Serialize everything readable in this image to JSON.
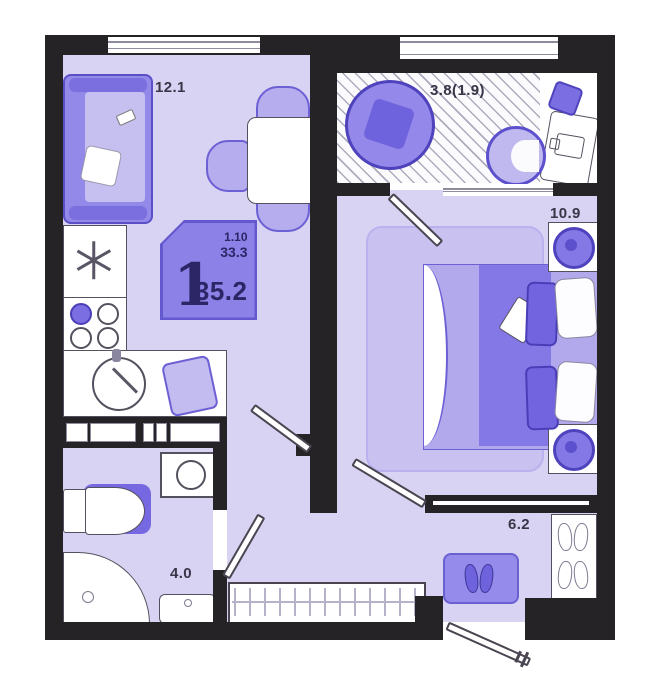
{
  "rooms": {
    "living": {
      "label": "12.1"
    },
    "balcony": {
      "label": "3.8(1.9)"
    },
    "bedroom": {
      "label": "10.9"
    },
    "hallway": {
      "label": "6.2"
    },
    "bathroom": {
      "label": "4.0"
    }
  },
  "badge": {
    "rooms": "1",
    "line1": "1.10",
    "line2": "33.3",
    "area": "35.2"
  },
  "colors": {
    "wall": "#262327",
    "floor": "#d8d3f2",
    "accent_dark": "#7164de",
    "accent_mid": "#8b81e7",
    "accent_light": "#c9c2f1",
    "badge_bg": "#8b81e7"
  }
}
